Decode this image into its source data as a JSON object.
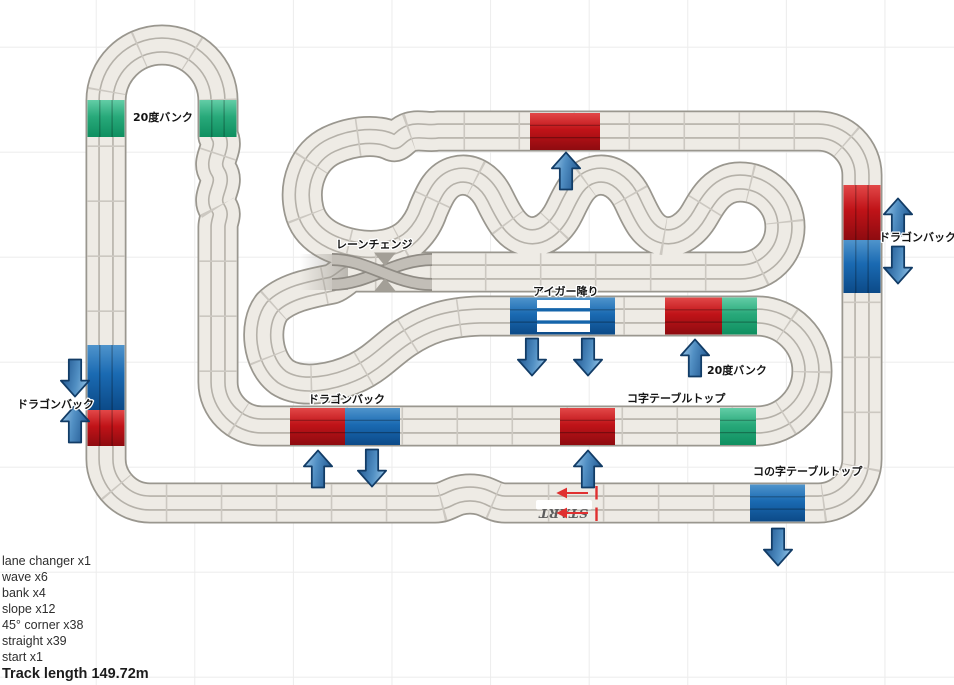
{
  "annotations": [
    {
      "id": "bank20-topleft",
      "text": "20度バンク"
    },
    {
      "id": "lane-change",
      "text": "レーンチェンジ"
    },
    {
      "id": "eiger-drop",
      "text": "アイガー降り"
    },
    {
      "id": "dragonback-left",
      "text": "ドラゴンバック"
    },
    {
      "id": "dragonback-center",
      "text": "ドラゴンバック"
    },
    {
      "id": "dragonback-right",
      "text": "ドラゴンバック"
    },
    {
      "id": "tabletop-u",
      "text": "コ字テーブルトップ"
    },
    {
      "id": "tabletop-ko",
      "text": "コの字テーブルトップ"
    },
    {
      "id": "bank20-center",
      "text": "20度バンク"
    },
    {
      "id": "start",
      "text": "START"
    }
  ],
  "summary": {
    "items": [
      "lane changer x1",
      "wave x6",
      "bank x4",
      "slope x12",
      "45° corner x38",
      "straight x39",
      "start x1"
    ],
    "track_length": "Track length 149.72m"
  },
  "arrows": [
    {
      "icon": "down-arrow",
      "section": "dragonback-left-blue"
    },
    {
      "icon": "up-arrow",
      "section": "dragonback-left-red"
    },
    {
      "icon": "up-arrow",
      "section": "dragonback-center-red"
    },
    {
      "icon": "down-arrow",
      "section": "dragonback-center-blue"
    },
    {
      "icon": "up-arrow",
      "section": "tabletop-u-red"
    },
    {
      "icon": "down-arrow",
      "section": "eiger-drop-left"
    },
    {
      "icon": "down-arrow",
      "section": "eiger-drop-right"
    },
    {
      "icon": "up-arrow",
      "section": "bank20-center-red"
    },
    {
      "icon": "up-arrow",
      "section": "top-straight-red"
    },
    {
      "icon": "up-arrow",
      "section": "dragonback-right-red"
    },
    {
      "icon": "down-arrow",
      "section": "dragonback-right-blue"
    },
    {
      "icon": "down-arrow",
      "section": "tabletop-ko-blue"
    }
  ],
  "colors": {
    "track_surface": "#eeebe5",
    "track_border": "#9a978f",
    "lane_line": "#b5b1a9",
    "red_section": "#c3161c",
    "blue_section": "#1668b0",
    "green_section": "#2aa876",
    "arrow_blue": "#5290c4",
    "start_accent": "#e03030"
  }
}
